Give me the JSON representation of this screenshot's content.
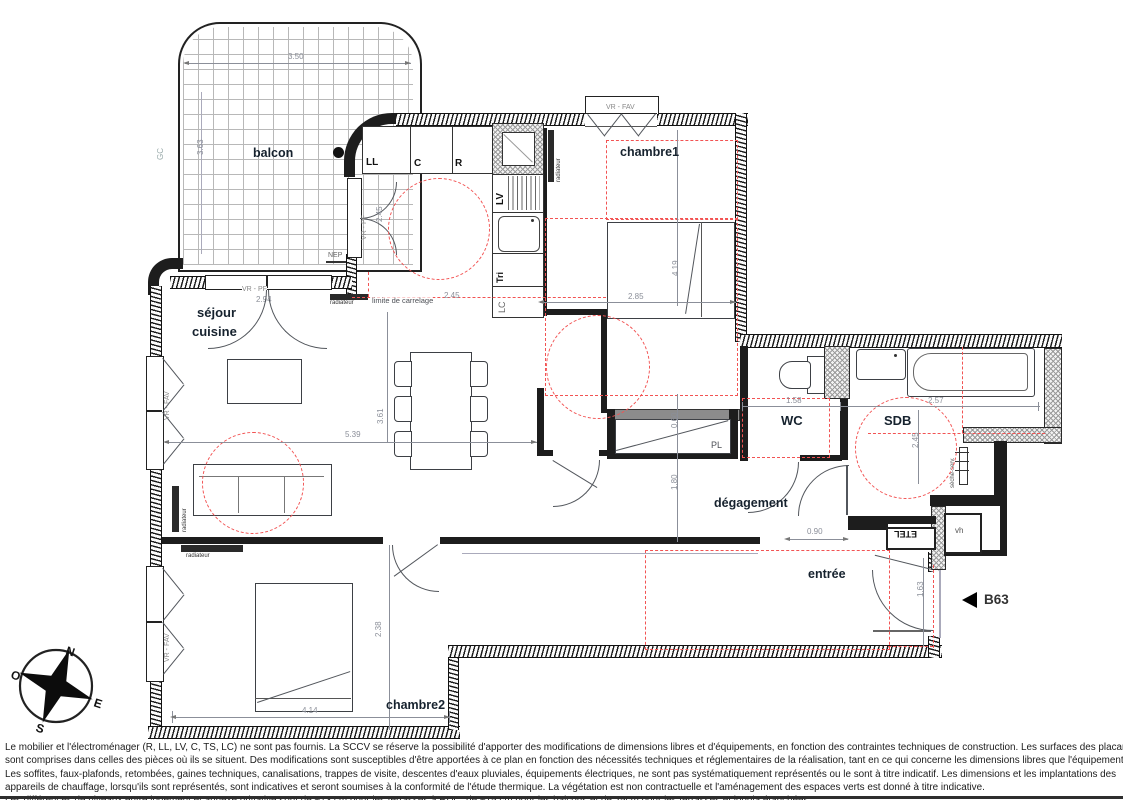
{
  "unit_label": "B63",
  "rooms": {
    "balcon": "balcon",
    "chambre1": "chambre1",
    "sejour": "séjour",
    "cuisine": "cuisine",
    "wc": "WC",
    "sdb": "SDB",
    "degagement": "dégagement",
    "entree": "entrée",
    "chambre2": "chambre2"
  },
  "kitchen": {
    "ll": "LL",
    "c": "C",
    "r": "R",
    "lv": "LV",
    "tri": "Tri",
    "lc": "LC"
  },
  "annotations": {
    "gc": "GC",
    "nep": "NEP",
    "vr_pf": "VR - PF",
    "vr_fav": "VR - FAV",
    "radiateur": "radiateur",
    "limite_carrelage": "limite de carrelage",
    "seche_serviette": "sèche-serv.",
    "placard": "PL",
    "etel": "ETEL",
    "vh": "vh"
  },
  "dims": {
    "balcon_w": "3.50",
    "balcon_h": "3.63",
    "sejour_window": "2.94",
    "cuisine_h": "2.45",
    "carrelage": "2.45",
    "chambre1_w": "2.85",
    "chambre1_h": "4.19",
    "sejour_w": "5.39",
    "sejour_h": "3.61",
    "wc_w": "1.58",
    "sdb_w": "2.57",
    "sdb_h": "2.45",
    "placard_d": "0.60",
    "degagement_h": "1.80",
    "passage": "0.90",
    "entree_h": "1.63",
    "chambre2_w": "4.14",
    "chambre2_h": "2.38"
  },
  "compass": {
    "n": "N",
    "s": "S",
    "e": "E",
    "o": "O"
  },
  "footer": {
    "lines": [
      "Le mobilier et l'électroménager (R, LL, LV, C, TS, LC) ne sont pas fournis. La SCCV se réserve la possibilité d'apporter des modifications de dimensions libres et d'équipements, en fonction des contraintes techniques de construction. Les surfaces des placards",
      "sont comprises dans celles des pièces où ils se situent. Des modifications sont susceptibles d'être apportées à ce plan en fonction des nécessités techniques et réglementaires de la réalisation, tant en ce qui concerne les dimensions libres que l'équipement.",
      "Les soffites, faux-plafonds, retombées, gaines techniques, canalisations, trappes de visite, descentes d'eaux pluviales, équipements électriques, ne sont pas systématiquement représentés ou le sont à titre indicatif. Les dimensions et les implantations des",
      "appareils de chauffage, lorsqu'ils sont représentés, sont indicatives et seront soumises à la conformité de l'étude thermique. La végétation est non contractuelle et l'aménagement des espaces verts est donné à titre indicative.",
      "Les différences de niveaux entre logement et annexe privative sont de ~13 cm pour les terrasses à RDC, de ~15 cm pour les balcons et de 25cm pour les terrasses et loggia étanchées."
    ]
  }
}
